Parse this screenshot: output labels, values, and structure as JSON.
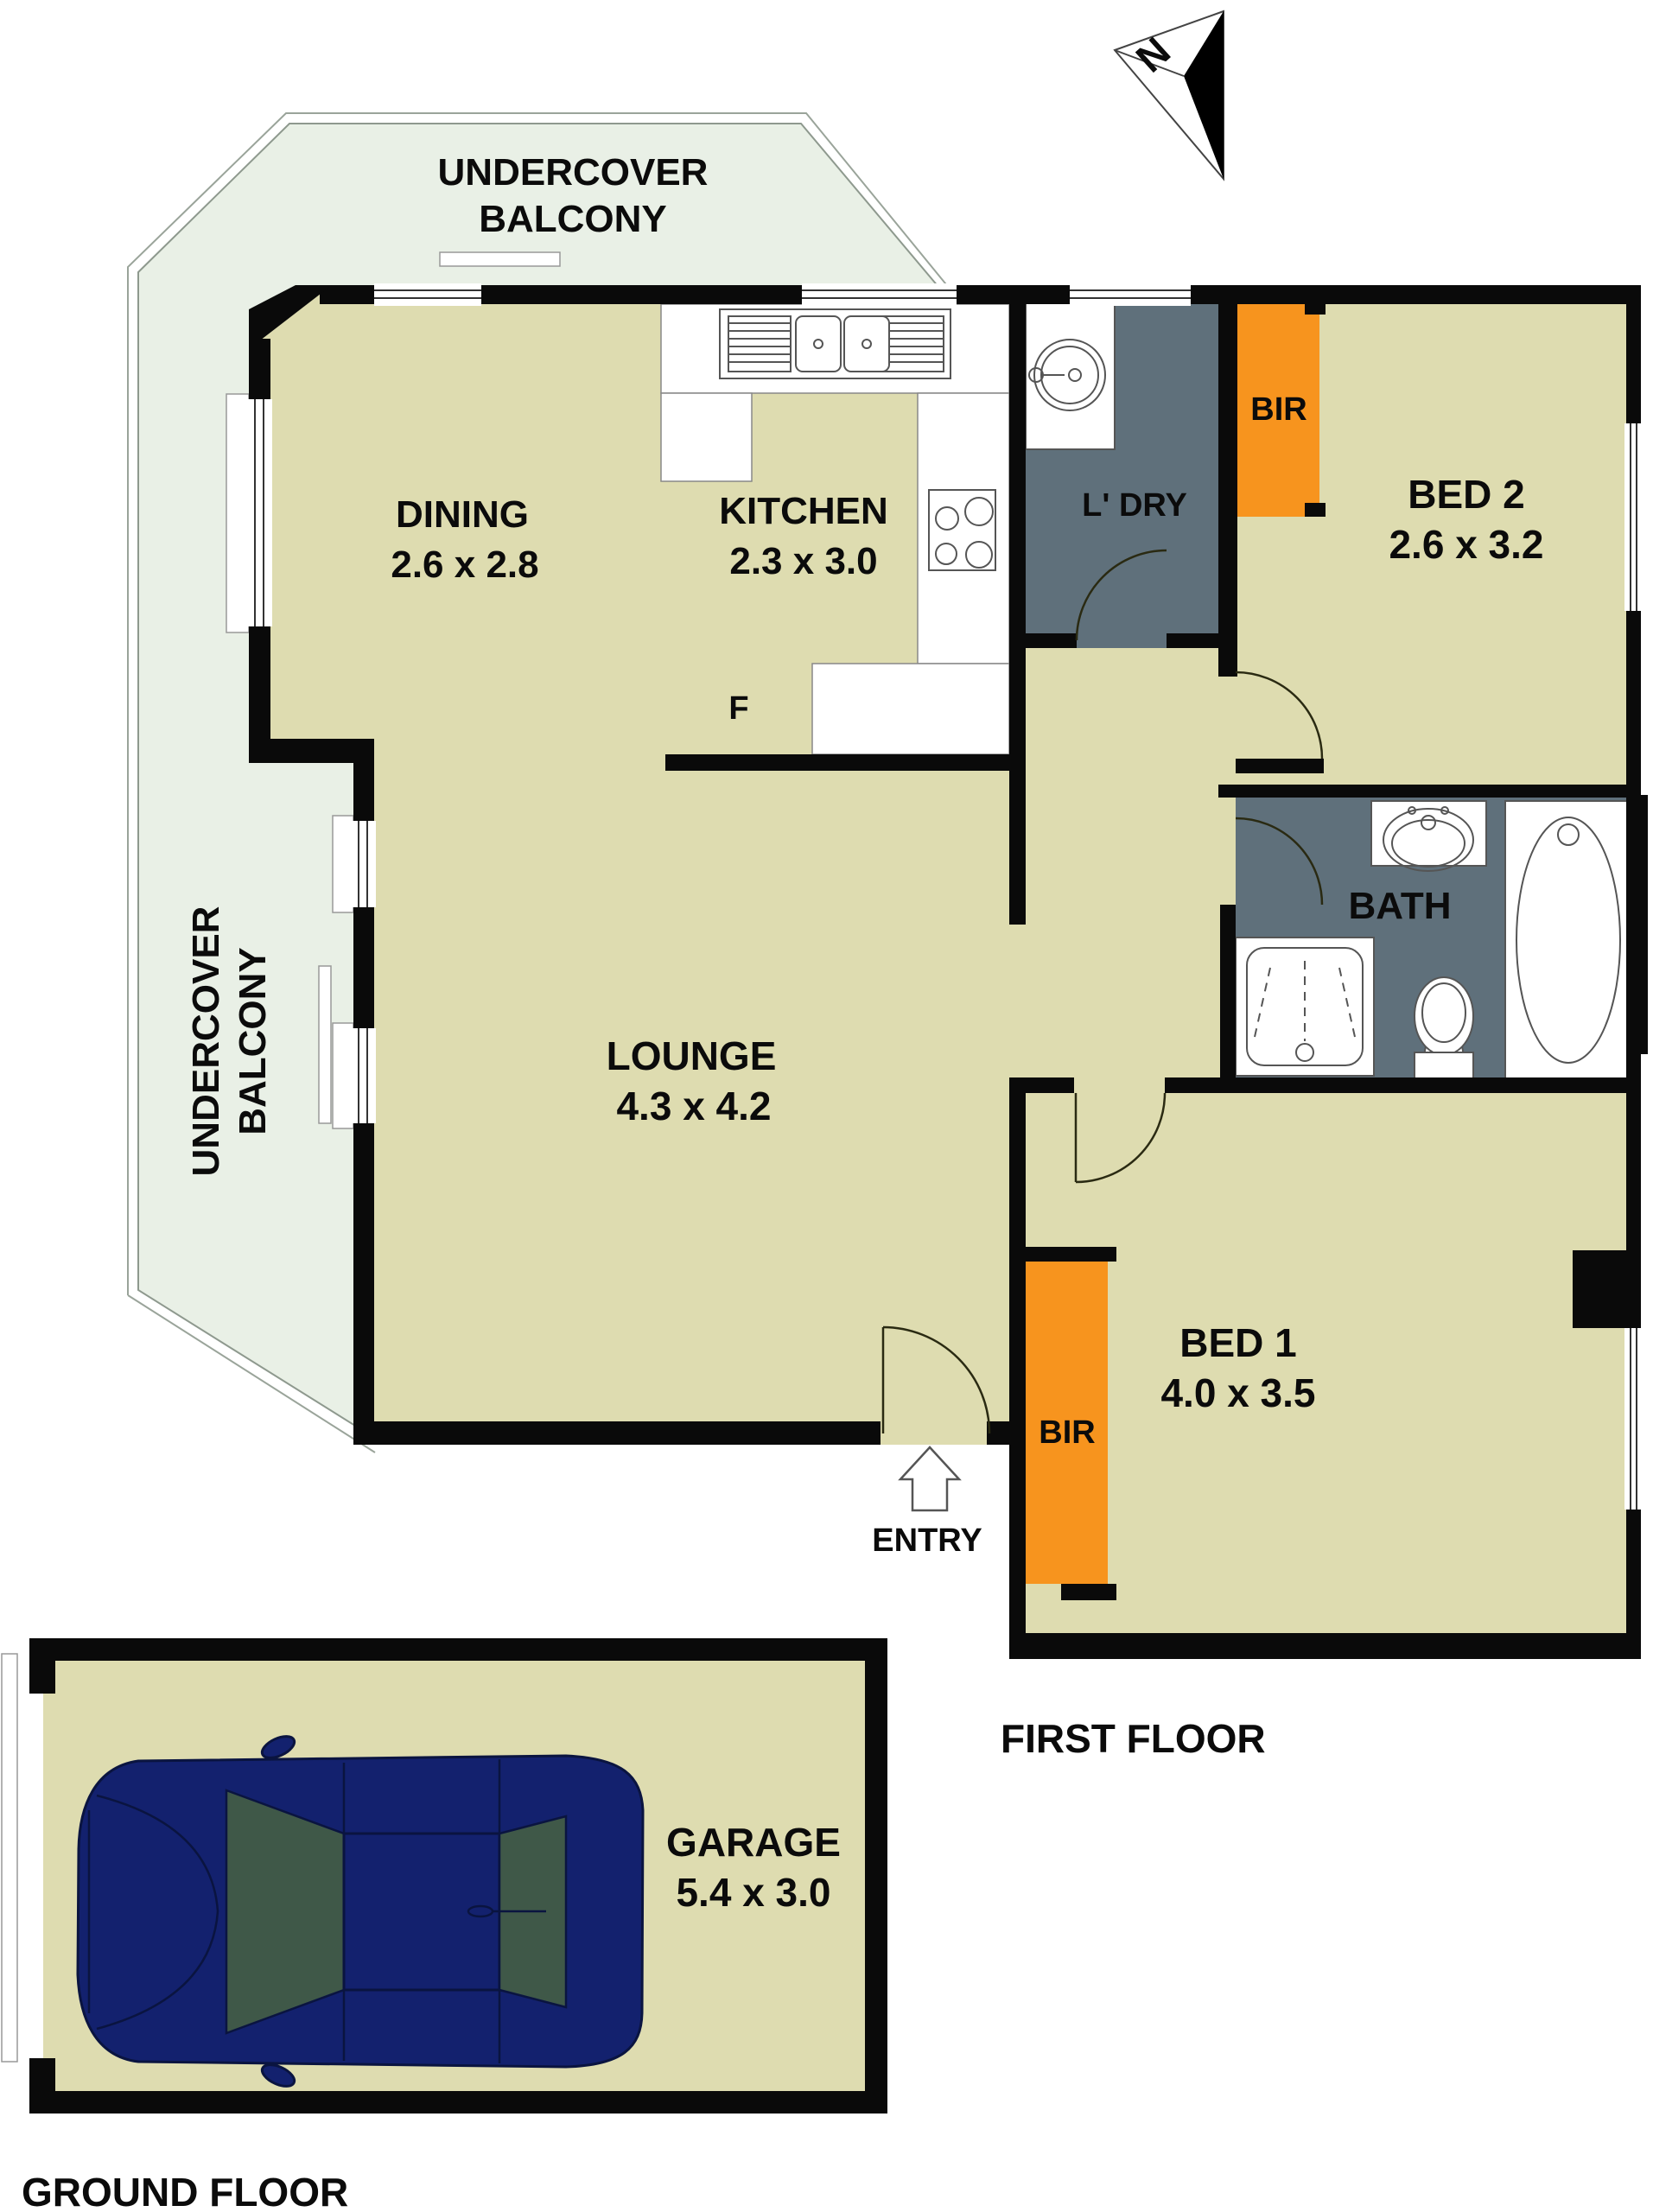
{
  "compass": {
    "label": "N"
  },
  "balcony_top": {
    "line1": "UNDERCOVER",
    "line2": "BALCONY"
  },
  "balcony_left": {
    "line1": "UNDERCOVER",
    "line2": "BALCONY"
  },
  "rooms": {
    "dining": {
      "name": "DINING",
      "dims": "2.6 x 2.8"
    },
    "kitchen": {
      "name": "KITCHEN",
      "dims": "2.3 x 3.0"
    },
    "fridge": {
      "label": "F"
    },
    "laundry": {
      "name": "L' DRY"
    },
    "bed2": {
      "name": "BED 2",
      "dims": "2.6 x 3.2"
    },
    "bath": {
      "name": "BATH"
    },
    "lounge": {
      "name": "LOUNGE",
      "dims": "4.3 x 4.2"
    },
    "bed1": {
      "name": "BED 1",
      "dims": "4.0 x 3.5"
    },
    "garage": {
      "name": "GARAGE",
      "dims": "5.4 x 3.0"
    },
    "bir1": {
      "label": "BIR"
    },
    "bir2": {
      "label": "BIR"
    },
    "entry": {
      "label": "ENTRY"
    }
  },
  "floors": {
    "first": "FIRST FLOOR",
    "ground": "GROUND FLOOR"
  },
  "colors": {
    "floor": "#dedcb0",
    "balcony": "#e9f0e6",
    "wet_area": "#5f707b",
    "robe": "#f7941e",
    "wall": "#0a0a0a",
    "car_body": "#13216e",
    "car_glass": "#3f5848"
  }
}
